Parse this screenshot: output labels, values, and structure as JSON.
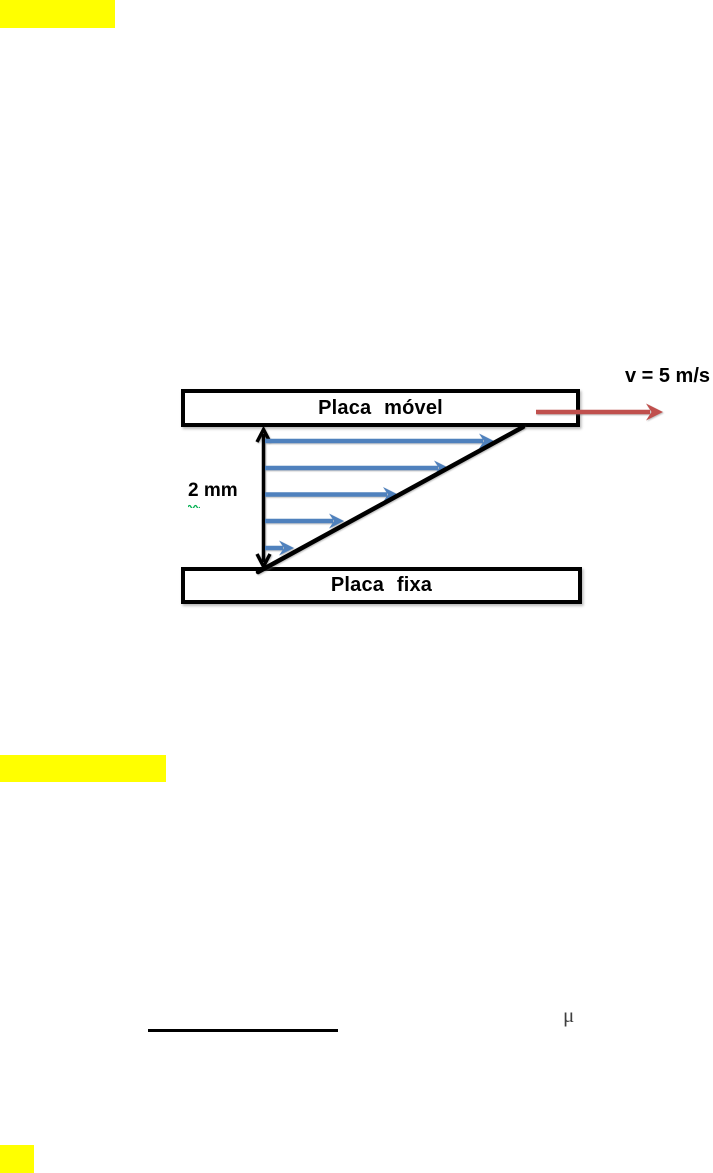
{
  "colors": {
    "highlight_yellow": "#FFFF00",
    "arrow_red": "#C0504D",
    "arrow_blue": "#4F81BD",
    "diagram_black": "#000000",
    "spellcheck_green": "#00B050",
    "mu_gray": "#3F3F3F"
  },
  "diagram": {
    "top_plate_label": "Placa móvel",
    "bottom_plate_label": "Placa fixa",
    "velocity_label": "v = 5 m/s",
    "gap_value": "2",
    "gap_unit": "mm"
  },
  "equation": {
    "mu_symbol": "μ"
  }
}
